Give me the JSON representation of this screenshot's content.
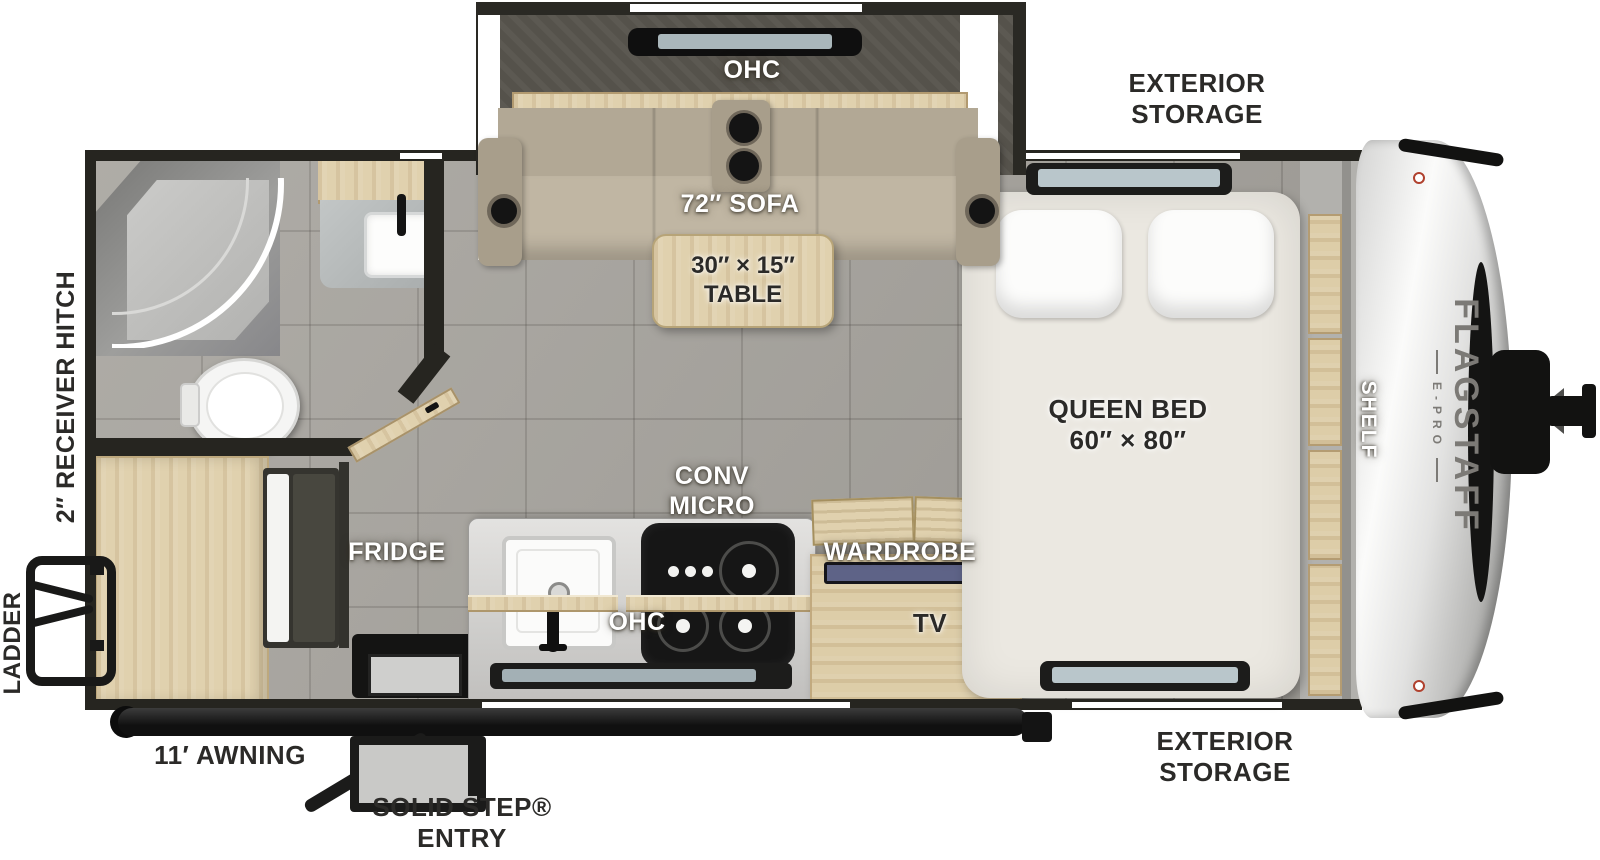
{
  "labels": {
    "ohc_slide": "OHC",
    "sofa": "72″ SOFA",
    "table": "30″ × 15″\nTABLE",
    "conv_micro": "CONV\nMICRO",
    "fridge": "FRIDGE",
    "wardrobe": "WARDROBE",
    "tv": "TV",
    "ohc_kitchen": "OHC",
    "queen_bed": "QUEEN BED\n60″ × 80″",
    "shelf": "SHELF",
    "exterior_storage_top": "EXTERIOR\nSTORAGE",
    "exterior_storage_bottom": "EXTERIOR\nSTORAGE",
    "receiver_hitch": "2″ RECEIVER HITCH",
    "ladder": "LADDER",
    "awning": "11′ AWNING",
    "solid_step": "SOLID STEP®\nENTRY"
  },
  "branding": {
    "name": "FLAGSTAFF",
    "sub": "E-PRO"
  },
  "colors": {
    "wall": "#262520",
    "floor_tile": "#a7a49e",
    "wood": "#e0d1ae",
    "sofa": "#bcb2a0",
    "mattress": "#ebe8e1",
    "counter": "#d6d5d3",
    "cooktop": "#161616",
    "front_cap": "#e9e9e9",
    "accent_black": "#121211",
    "label_dark": "#2b2a28",
    "label_light": "#ffffff"
  }
}
